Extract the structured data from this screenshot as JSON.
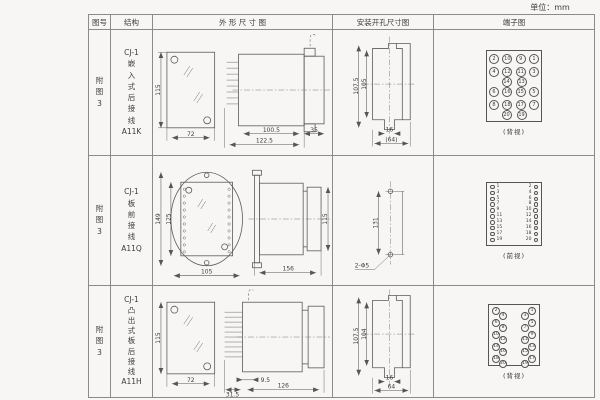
{
  "unit_label": "单位：mm",
  "colors": {
    "line": "#5a5a5a",
    "border": "#8b8b8b",
    "bg": "#f7f6f4"
  },
  "table": {
    "headers": [
      "图号",
      "结构",
      "外 形 尺 寸 图",
      "安装开孔尺寸图",
      "端子图"
    ],
    "rows": [
      {
        "fig_no": [
          "附",
          "图",
          "3"
        ],
        "structure": [
          "CJ-1",
          "嵌",
          "入",
          "式",
          "后",
          "接",
          "线",
          "A11K"
        ],
        "outline_dims": {
          "height": "115",
          "width": "72",
          "body": "100.5",
          "total": "122.5",
          "flange": "35"
        },
        "mount_dims": {
          "outer": "107.5",
          "inner": "105",
          "slot": "16",
          "width": "(64)"
        },
        "terminal": {
          "caption": "(背视)",
          "r1": [
            "2",
            "10",
            "9",
            "1"
          ],
          "r2": [
            "4",
            "12",
            "11",
            "3"
          ],
          "r3": [
            "14",
            "13"
          ],
          "r4": [
            "6",
            "16",
            "15",
            "5"
          ],
          "r5": [
            "8",
            "18",
            "17",
            "7"
          ],
          "r6": [
            "20",
            "19"
          ]
        }
      },
      {
        "fig_no": [
          "附",
          "图",
          "3"
        ],
        "structure": [
          "CJ-1",
          "板",
          "前",
          "接",
          "线",
          "A11Q"
        ],
        "outline_dims": {
          "outer_h": "149",
          "inner_h": "125",
          "width": "105",
          "length": "156",
          "height": "115"
        },
        "mount_dims": {
          "spacing": "131",
          "holes": "2-Φ5"
        },
        "terminal": {
          "caption": "(前视)",
          "pairs": [
            [
              "1",
              "2"
            ],
            [
              "3",
              "4"
            ],
            [
              "5",
              "6"
            ],
            [
              "7",
              "8"
            ],
            [
              "9",
              "10"
            ],
            [
              "11",
              "12"
            ],
            [
              "13",
              "14"
            ],
            [
              "15",
              "16"
            ],
            [
              "17",
              "18"
            ],
            [
              "19",
              "20"
            ]
          ]
        }
      },
      {
        "fig_no": [
          "附",
          "图",
          "3"
        ],
        "structure": [
          "CJ-1",
          "凸",
          "出",
          "式",
          "板",
          "后",
          "接",
          "线",
          "A11H"
        ],
        "outline_dims": {
          "height": "115",
          "width": "72",
          "pins": "31.5",
          "front": "9.5",
          "length": "126"
        },
        "mount_dims": {
          "outer": "107.5",
          "inner": "104",
          "slot": "16",
          "width": "64"
        },
        "terminal": {
          "caption": "(背视)",
          "lo": [
            "2",
            "6",
            "10",
            "14",
            "18"
          ],
          "li": [
            "4",
            "8",
            "12",
            "16",
            "20"
          ],
          "ri": [
            "3",
            "7",
            "11",
            "15",
            "19"
          ],
          "ro": [
            "1",
            "5",
            "9",
            "13",
            "17"
          ]
        }
      }
    ]
  }
}
